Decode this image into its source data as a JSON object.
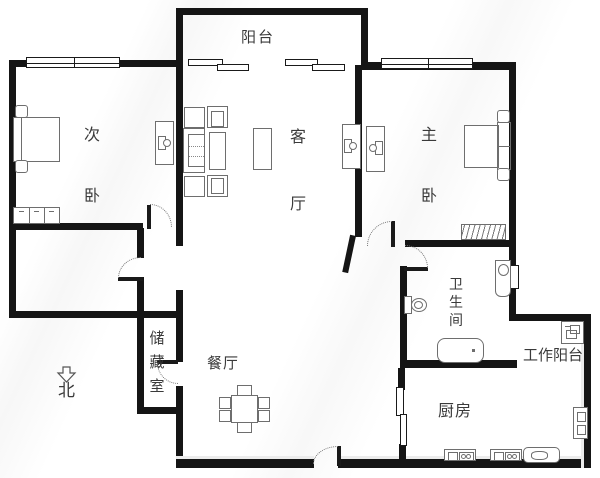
{
  "title": "apartment-floor-plan",
  "colors": {
    "wall": "#151515",
    "furniture_line": "#6e6e6e",
    "text": "#3a3a3a",
    "background": "#ffffff"
  },
  "rooms": {
    "balcony": {
      "label": "阳台"
    },
    "second_bedroom": {
      "label": "次卧"
    },
    "living_room": {
      "label": "客厅"
    },
    "master_bedroom": {
      "label": "主卧"
    },
    "bathroom": {
      "label": "卫生间"
    },
    "storage_room": {
      "label": "储藏室"
    },
    "dining_room": {
      "label": "餐厅"
    },
    "kitchen": {
      "label": "厨房"
    },
    "work_balcony": {
      "label": "工作阳台"
    }
  },
  "compass": {
    "north_label": "北"
  }
}
